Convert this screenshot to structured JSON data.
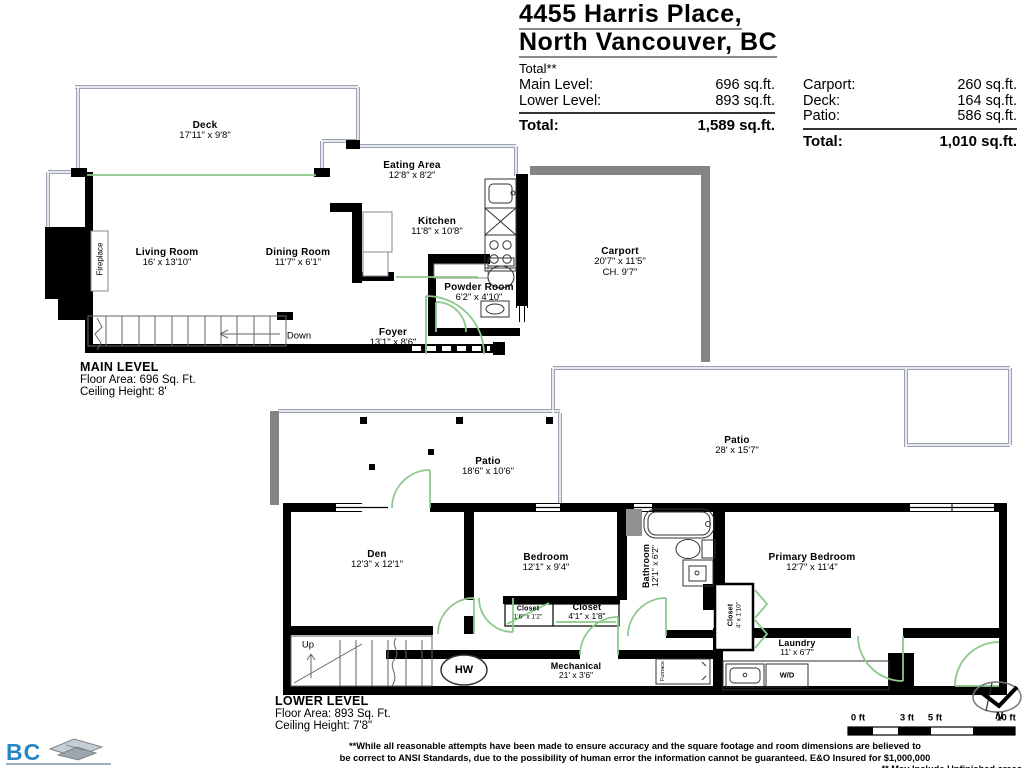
{
  "header": {
    "title_line1": "4455 Harris Place,",
    "title_line2": "North Vancouver, BC",
    "total_note": "Total**",
    "interior_areas": {
      "rows": [
        {
          "label": "Main Level:",
          "value": "696 sq.ft."
        },
        {
          "label": "Lower Level:",
          "value": "893 sq.ft."
        }
      ],
      "total_label": "Total:",
      "total_value": "1,589 sq.ft."
    },
    "exterior_areas": {
      "rows": [
        {
          "label": "Carport:",
          "value": "260 sq.ft."
        },
        {
          "label": "Deck:",
          "value": "164 sq.ft."
        },
        {
          "label": "Patio:",
          "value": "586 sq.ft."
        }
      ],
      "total_label": "Total:",
      "total_value": "1,010 sq.ft."
    }
  },
  "main_level": {
    "heading": "MAIN LEVEL",
    "floor_area": "Floor Area: 696 Sq. Ft.",
    "ceiling_height": "Ceiling Height: 8'",
    "rooms": {
      "deck": {
        "name": "Deck",
        "dims": "17'11\" x 9'8\""
      },
      "eating_area": {
        "name": "Eating Area",
        "dims": "12'8\" x 8'2\""
      },
      "kitchen": {
        "name": "Kitchen",
        "dims": "11'8\" x 10'8\""
      },
      "living_room": {
        "name": "Living Room",
        "dims": "16' x 13'10\""
      },
      "dining_room": {
        "name": "Dining Room",
        "dims": "11'7\" x 6'1\""
      },
      "powder_room": {
        "name": "Powder Room",
        "dims": "6'2\" x 4'10\""
      },
      "foyer": {
        "name": "Foyer",
        "dims": "13'1\" x 8'6\""
      },
      "carport": {
        "name": "Carport",
        "dims": "20'7\" x 11'5\"",
        "ceiling": "CH. 9'7\""
      }
    },
    "fireplace_label": "Fireplace",
    "stairs_label": "Down"
  },
  "lower_level": {
    "heading": "LOWER LEVEL",
    "floor_area": "Floor Area: 893 Sq. Ft.",
    "ceiling_height": "Ceiling Height: 7'8\"",
    "rooms": {
      "patio_upper": {
        "name": "Patio",
        "dims": "28' x 15'7\""
      },
      "patio_lower": {
        "name": "Patio",
        "dims": "18'6\" x 10'6\""
      },
      "den": {
        "name": "Den",
        "dims": "12'3\" x 12'1\""
      },
      "bedroom": {
        "name": "Bedroom",
        "dims": "12'1\" x 9'4\""
      },
      "bathroom": {
        "name": "Bathroom",
        "dims": "12'1\" x 6'2\""
      },
      "primary_bedroom": {
        "name": "Primary Bedroom",
        "dims": "12'7\" x 11'4\""
      },
      "closet_small": {
        "name": "Closet",
        "dims": "1'6\" x 1'2\""
      },
      "closet_hall": {
        "name": "Closet",
        "dims": "4'1\" x 1'8\""
      },
      "closet_primary": {
        "name": "Closet",
        "dims": "4' x 1'10\""
      },
      "laundry": {
        "name": "Laundry",
        "dims": "11' x 6'7\""
      },
      "mechanical": {
        "name": "Mechanical",
        "dims": "21' x 3'6\""
      }
    },
    "hw_label": "HW",
    "wd_label": "W/D",
    "furnace_label": "Furnace",
    "stairs_label": "Up"
  },
  "footer": {
    "logo": {
      "bc": "BC",
      "name": "FLOOR PLANS"
    },
    "disclaimer_line1": "**While all reasonable attempts have been made to ensure accuracy and the square footage and room dimensions are believed to",
    "disclaimer_line2": "be correct to ANSI Standards, due to the possibility of human error the information cannot be guaranteed. E&O Insured for $1,000,000",
    "disclaimer_line3": "** May Include Unfinished areas",
    "scale_labels": [
      "0 ft",
      "3 ft",
      "5 ft",
      "10 ft"
    ],
    "north_label": "N"
  },
  "colors": {
    "wall": "#000000",
    "carport_wall": "#848484",
    "railing": "#9aa3b5",
    "door": "#8cc98c",
    "logo_blue": "#2a85c7",
    "logo_navy": "#16395c"
  }
}
